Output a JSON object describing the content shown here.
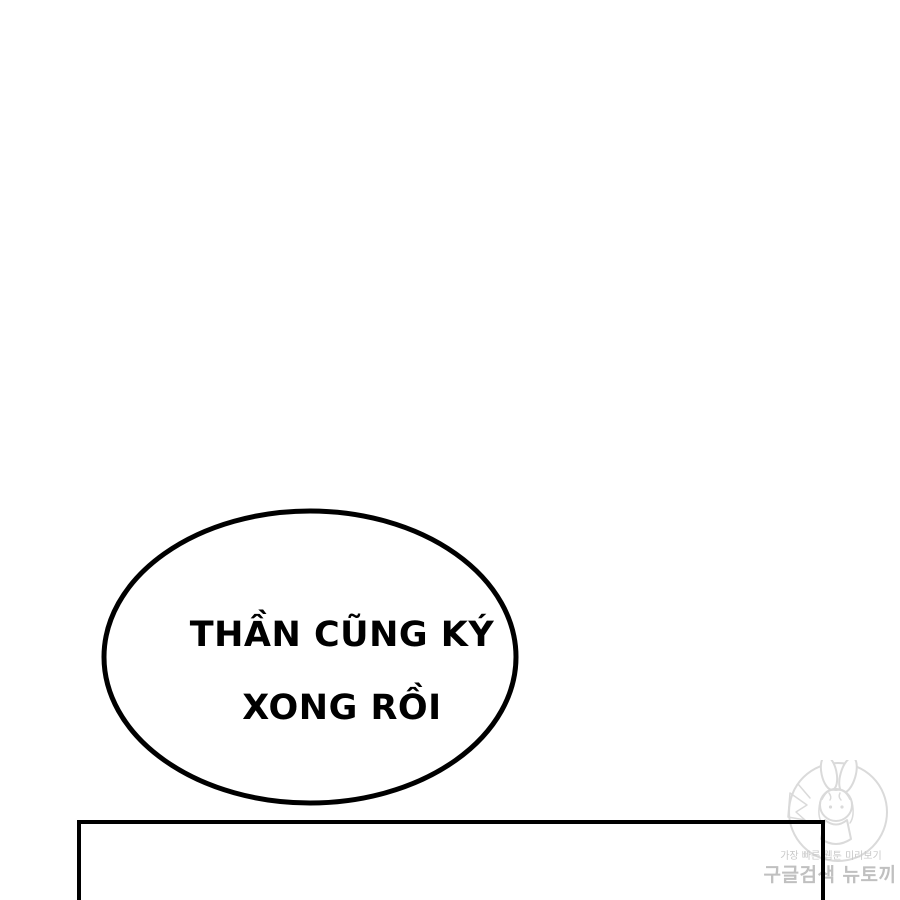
{
  "bubble": {
    "line1": "THẦN CŨNG KÝ",
    "line2": "XONG RỒI"
  },
  "watermark": {
    "tagline": "가장 빠른 웹툰 미리보기",
    "brand": "구글검색 뉴토끼",
    "logo": "rabbit-girl-circle-logo"
  },
  "colors": {
    "ink": "#000000",
    "paper": "#ffffff",
    "watermark_text": "#c4c4c4",
    "watermark_line": "#dadada"
  }
}
